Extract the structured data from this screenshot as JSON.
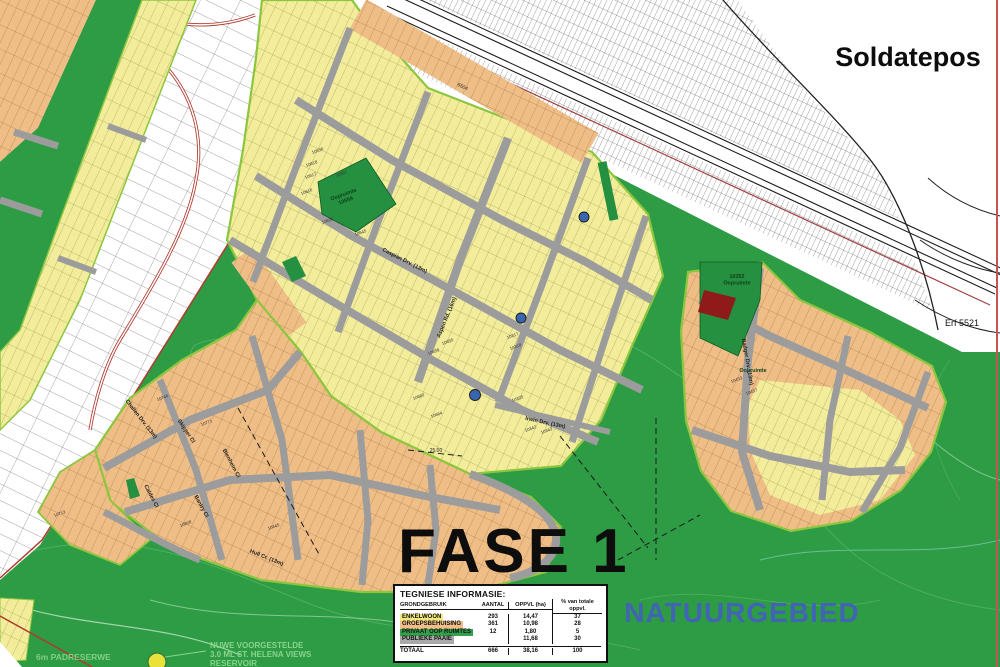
{
  "labels": {
    "soldatepos": "Soldatepos",
    "fase": "FASE 1",
    "natuurgebied": "NATUURGEBIED",
    "erf_5521": "Erf 5521",
    "corridor_erf": "6504",
    "padreserwe": "6m PADRESERWE",
    "reservoir_note": [
      "NUWE VOORGESTELDE",
      "3.0 ML ST. HELENA VIEWS",
      "RESERVOIR"
    ],
    "dimension": "25.00"
  },
  "open_spaces": [
    {
      "x": 344,
      "y": 196,
      "rot": -20,
      "lines": [
        "Oopruimte",
        "10559"
      ]
    },
    {
      "x": 737,
      "y": 278,
      "rot": 0,
      "lines": [
        "10352",
        "Oopruimte"
      ]
    },
    {
      "x": 753,
      "y": 372,
      "rot": 0,
      "lines": [
        "Oopruimte"
      ]
    }
  ],
  "streets": [
    {
      "name": "Caspian Drv. (13m)",
      "x": 404,
      "y": 262,
      "rot": 27
    },
    {
      "name": "Aspen Rd. (16m)",
      "x": 448,
      "y": 318,
      "rot": -68
    },
    {
      "name": "Irwin Drv. (13m)",
      "x": 545,
      "y": 424,
      "rot": 12
    },
    {
      "name": "Challen Drv. (13m)",
      "x": 140,
      "y": 420,
      "rot": 52
    },
    {
      "name": "Skipper Cl",
      "x": 185,
      "y": 432,
      "rot": 56
    },
    {
      "name": "Blenheim Cl",
      "x": 230,
      "y": 464,
      "rot": 62
    },
    {
      "name": "Caldes Cl",
      "x": 150,
      "y": 497,
      "rot": 62
    },
    {
      "name": "Bantry Cl",
      "x": 200,
      "y": 507,
      "rot": 62
    },
    {
      "name": "Hull Cr. (13m)",
      "x": 266,
      "y": 559,
      "rot": 22
    },
    {
      "name": "Badger Drv. (13m)",
      "x": 746,
      "y": 362,
      "rot": 80
    }
  ],
  "plot_numbers": [
    {
      "t": "10536",
      "x": 318,
      "y": 152
    },
    {
      "t": "10618",
      "x": 312,
      "y": 165
    },
    {
      "t": "10617",
      "x": 311,
      "y": 177
    },
    {
      "t": "10616",
      "x": 307,
      "y": 193
    },
    {
      "t": "10587",
      "x": 342,
      "y": 175
    },
    {
      "t": "10630",
      "x": 328,
      "y": 222
    },
    {
      "t": "10645",
      "x": 361,
      "y": 234
    },
    {
      "t": "10655",
      "x": 448,
      "y": 343
    },
    {
      "t": "10658",
      "x": 434,
      "y": 353
    },
    {
      "t": "10660",
      "x": 419,
      "y": 398
    },
    {
      "t": "10664",
      "x": 437,
      "y": 416
    },
    {
      "t": "10317",
      "x": 513,
      "y": 337
    },
    {
      "t": "10318",
      "x": 516,
      "y": 348
    },
    {
      "t": "10335",
      "x": 518,
      "y": 400
    },
    {
      "t": "10342",
      "x": 531,
      "y": 430
    },
    {
      "t": "10343",
      "x": 547,
      "y": 432
    },
    {
      "t": "10433",
      "x": 737,
      "y": 381
    },
    {
      "t": "10437",
      "x": 752,
      "y": 393
    },
    {
      "t": "10746",
      "x": 163,
      "y": 399
    },
    {
      "t": "10771",
      "x": 207,
      "y": 424
    },
    {
      "t": "10713",
      "x": 60,
      "y": 515
    },
    {
      "t": "10808",
      "x": 186,
      "y": 525
    },
    {
      "t": "10845",
      "x": 274,
      "y": 528
    }
  ],
  "colors": {
    "nature_green": "#2E9B45",
    "residential_yellow": "#F2EC9B",
    "group_housing_orange": "#EFBE86",
    "road_gray": "#9C9C9C",
    "open_space_green": "#249040",
    "boundary_green": "#8CC63F",
    "cadastral_red": "#B03A2E",
    "dark_red_plot": "#8E1A1A",
    "roundabout_blue": "#3A66B0",
    "natuur_text_blue": "#4164B4"
  },
  "table": {
    "title": "TEGNIESE INFORMASIE:",
    "headers": [
      "GRONDGEBRUIK",
      "AANTAL",
      "OPPVL (ha)",
      "% van totale oppvl."
    ],
    "rows": [
      {
        "label": "ENKELWOON",
        "aantal": "293",
        "oppvl": "14,47",
        "pct": "37",
        "color": "#F2E87B"
      },
      {
        "label": "GROEPSBEHUISING",
        "aantal": "361",
        "oppvl": "10,98",
        "pct": "28",
        "color": "#F0BE86"
      },
      {
        "label": "PRIVAAT OOP RUIMTES",
        "aantal": "12",
        "oppvl": "1,80",
        "pct": "5",
        "color": "#33A04C"
      },
      {
        "label": "PUBLIEKE PAAIE",
        "aantal": "",
        "oppvl": "11,68",
        "pct": "30",
        "color": "#A9A9A9"
      }
    ],
    "total": {
      "label": "TOTAAL",
      "aantal": "666",
      "oppvl": "38,16",
      "pct": "100"
    }
  }
}
